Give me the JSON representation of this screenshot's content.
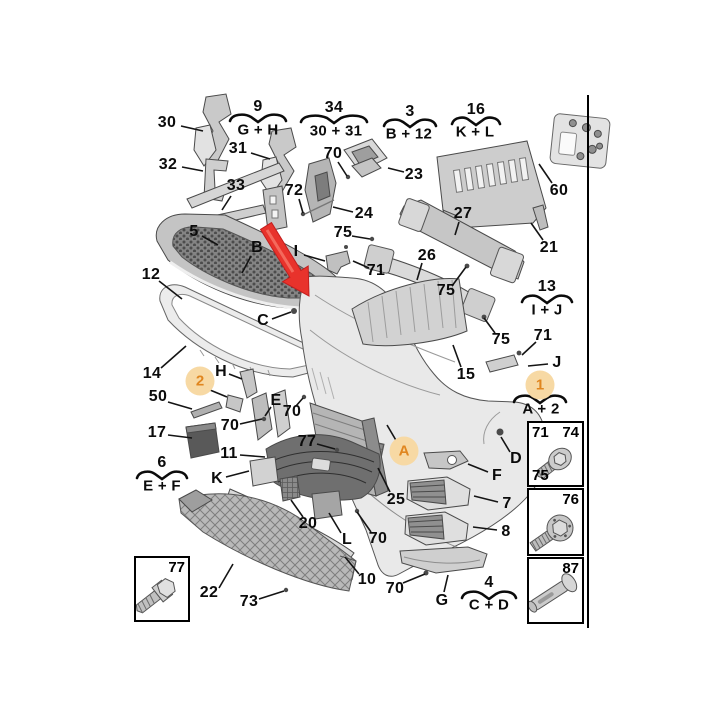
{
  "title": "Front bumper exploded parts diagram",
  "colors": {
    "badge_fill": "#f7d9a4",
    "badge_text": "#e0861f",
    "arrow_red": "#e8332c",
    "line": "#141414",
    "part_grey": "#d6d6d6"
  },
  "labels": [
    {
      "t": "30",
      "x": 167,
      "y": 123,
      "l": [
        181,
        126,
        203,
        131
      ]
    },
    {
      "t": "31",
      "x": 238,
      "y": 149,
      "l": [
        251,
        153,
        270,
        159
      ]
    },
    {
      "t": "32",
      "x": 168,
      "y": 165,
      "l": [
        182,
        167,
        203,
        171
      ]
    },
    {
      "t": "33",
      "x": 236,
      "y": 186,
      "l": [
        231,
        196,
        222,
        210
      ]
    },
    {
      "t": "70",
      "x": 333,
      "y": 154,
      "l": [
        338,
        162,
        347,
        176
      ]
    },
    {
      "t": "23",
      "x": 414,
      "y": 175,
      "l": [
        404,
        172,
        388,
        168
      ]
    },
    {
      "t": "60",
      "x": 559,
      "y": 191,
      "l": [
        552,
        183,
        539,
        164
      ]
    },
    {
      "t": "72",
      "x": 294,
      "y": 191,
      "l": [
        299,
        199,
        303,
        213
      ]
    },
    {
      "t": "24",
      "x": 364,
      "y": 214,
      "l": [
        353,
        212,
        333,
        207
      ]
    },
    {
      "t": "75",
      "x": 343,
      "y": 233,
      "l": [
        352,
        236,
        370,
        239
      ]
    },
    {
      "t": "27",
      "x": 463,
      "y": 214,
      "l": [
        459,
        222,
        455,
        235
      ]
    },
    {
      "t": "21",
      "x": 549,
      "y": 248,
      "l": [
        543,
        240,
        531,
        223
      ]
    },
    {
      "t": "5",
      "x": 194,
      "y": 232,
      "l": [
        202,
        236,
        218,
        245
      ]
    },
    {
      "t": "B",
      "x": 257,
      "y": 248,
      "l": [
        251,
        256,
        242,
        273
      ]
    },
    {
      "t": "I",
      "x": 296,
      "y": 252,
      "l": [
        304,
        255,
        325,
        261
      ]
    },
    {
      "t": "26",
      "x": 427,
      "y": 256,
      "l": [
        422,
        263,
        417,
        280
      ]
    },
    {
      "t": "71",
      "x": 376,
      "y": 271,
      "l": [
        369,
        268,
        353,
        261
      ]
    },
    {
      "t": "75",
      "x": 446,
      "y": 291,
      "l": [
        452,
        286,
        466,
        267
      ]
    },
    {
      "t": "12",
      "x": 151,
      "y": 275,
      "l": [
        159,
        281,
        182,
        299
      ]
    },
    {
      "t": "C",
      "x": 263,
      "y": 321,
      "l": [
        272,
        319,
        291,
        312
      ]
    },
    {
      "t": "75",
      "x": 501,
      "y": 340,
      "l": [
        495,
        333,
        484,
        318
      ]
    },
    {
      "t": "15",
      "x": 466,
      "y": 375,
      "l": [
        461,
        367,
        453,
        345
      ]
    },
    {
      "t": "71",
      "x": 543,
      "y": 336,
      "l": [
        536,
        342,
        522,
        355
      ]
    },
    {
      "t": "J",
      "x": 557,
      "y": 363,
      "l": [
        548,
        364,
        528,
        366
      ]
    },
    {
      "t": "14",
      "x": 152,
      "y": 374,
      "l": [
        161,
        368,
        186,
        346
      ]
    },
    {
      "t": "H",
      "x": 221,
      "y": 372,
      "l": [
        229,
        374,
        242,
        379
      ]
    },
    {
      "t": "50",
      "x": 158,
      "y": 397,
      "l": [
        168,
        402,
        192,
        409
      ]
    },
    {
      "t": "E",
      "x": 276,
      "y": 401,
      "l": [
        271,
        407,
        265,
        416
      ]
    },
    {
      "t": "70",
      "x": 292,
      "y": 412,
      "l": [
        296,
        406,
        303,
        398
      ]
    },
    {
      "t": "70",
      "x": 230,
      "y": 426,
      "l": [
        240,
        424,
        262,
        419
      ]
    },
    {
      "t": "17",
      "x": 157,
      "y": 433,
      "l": [
        168,
        435,
        192,
        438
      ]
    },
    {
      "t": "77",
      "x": 307,
      "y": 442,
      "l": [
        317,
        444,
        335,
        449
      ]
    },
    {
      "t": "11",
      "x": 229,
      "y": 454,
      "l": [
        240,
        455,
        265,
        457
      ]
    },
    {
      "t": "K",
      "x": 217,
      "y": 479,
      "l": [
        226,
        477,
        249,
        471
      ]
    },
    {
      "t": "25",
      "x": 396,
      "y": 500,
      "l": [
        390,
        492,
        378,
        468
      ]
    },
    {
      "t": "F",
      "x": 497,
      "y": 476,
      "l": [
        488,
        472,
        468,
        464
      ]
    },
    {
      "t": "D",
      "x": 516,
      "y": 459,
      "l": [
        510,
        452,
        501,
        437
      ]
    },
    {
      "t": "20",
      "x": 308,
      "y": 524,
      "l": [
        303,
        517,
        291,
        500
      ]
    },
    {
      "t": "7",
      "x": 507,
      "y": 504,
      "l": [
        498,
        502,
        474,
        496
      ]
    },
    {
      "t": "L",
      "x": 347,
      "y": 540,
      "l": [
        341,
        533,
        329,
        513
      ]
    },
    {
      "t": "70",
      "x": 378,
      "y": 539,
      "l": [
        371,
        532,
        357,
        512
      ]
    },
    {
      "t": "8",
      "x": 506,
      "y": 532,
      "l": [
        497,
        530,
        473,
        527
      ]
    },
    {
      "t": "10",
      "x": 367,
      "y": 580,
      "l": [
        359,
        574,
        345,
        557
      ]
    },
    {
      "t": "22",
      "x": 209,
      "y": 593,
      "l": [
        219,
        588,
        233,
        564
      ]
    },
    {
      "t": "73",
      "x": 249,
      "y": 602,
      "l": [
        259,
        599,
        284,
        591
      ]
    },
    {
      "t": "70",
      "x": 395,
      "y": 589,
      "l": [
        403,
        583,
        425,
        574
      ]
    },
    {
      "t": "G",
      "x": 442,
      "y": 601,
      "l": [
        444,
        592,
        448,
        575
      ]
    }
  ],
  "groups": [
    {
      "n": "9",
      "c": "G + H",
      "x": 258,
      "ny": 107,
      "by": 118,
      "cy": 130,
      "w": 56
    },
    {
      "n": "34",
      "c": "30 + 31",
      "x": 334,
      "cx": 336,
      "ny": 108,
      "by": 119,
      "cy": 131,
      "w": 66
    },
    {
      "n": "3",
      "c": "B + 12",
      "x": 410,
      "cx": 409,
      "ny": 112,
      "by": 123,
      "cy": 134,
      "w": 52
    },
    {
      "n": "16",
      "c": "K + L",
      "x": 476,
      "cx": 475,
      "ny": 110,
      "by": 121,
      "cy": 132,
      "w": 48
    },
    {
      "n": "13",
      "c": "I + J",
      "x": 547,
      "ny": 287,
      "by": 299,
      "cy": 310,
      "w": 50
    },
    {
      "n": "",
      "c": "A + 2",
      "x": 540,
      "cx": 541,
      "ny": 0,
      "by": 399,
      "cy": 409,
      "w": 52
    },
    {
      "n": "6",
      "c": "E + F",
      "x": 162,
      "ny": 463,
      "by": 475,
      "cy": 486,
      "w": 50
    },
    {
      "n": "4",
      "c": "C + D",
      "x": 489,
      "ny": 583,
      "by": 595,
      "cy": 605,
      "w": 54
    }
  ],
  "badges": [
    {
      "t": "2",
      "x": 200,
      "y": 381,
      "l": [
        210,
        390,
        227,
        397
      ]
    },
    {
      "t": "1",
      "x": 540,
      "y": 385,
      "l": null
    },
    {
      "t": "A",
      "x": 404,
      "y": 451,
      "l": [
        397,
        442,
        387,
        425
      ]
    }
  ],
  "legend": {
    "left_box": {
      "label": "77"
    },
    "right_boxes": [
      {
        "labels": {
          "tl": "71",
          "tr": "74",
          "bl": "75"
        }
      },
      {
        "labels": {
          "tr": "76"
        }
      },
      {
        "labels": {
          "tr": "87"
        }
      }
    ]
  }
}
